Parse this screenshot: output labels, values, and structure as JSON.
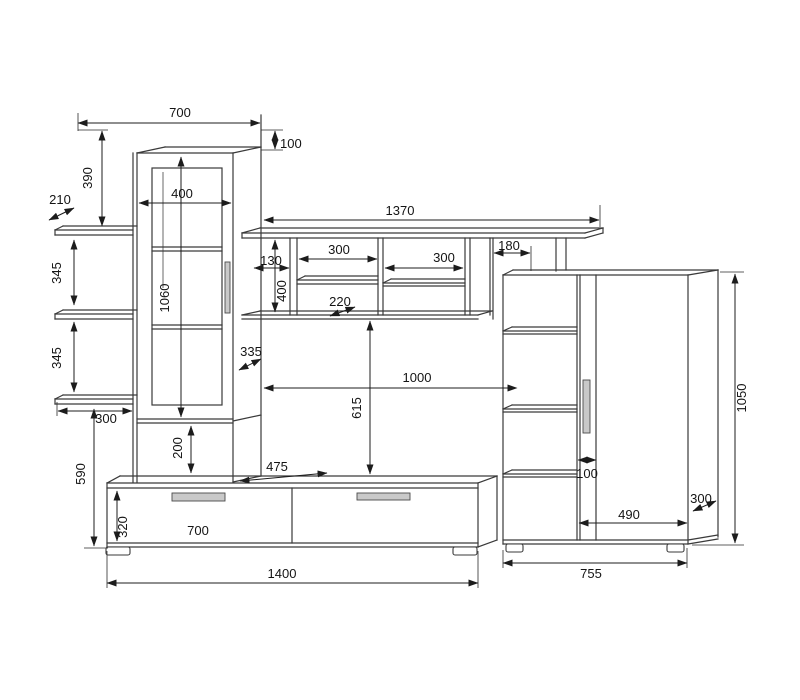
{
  "drawing_type": "furniture-wall-unit-dimension-diagram",
  "colors": {
    "background": "#ffffff",
    "line": "#3a3a3a",
    "dimension": "#1c1c1c",
    "handle_fill": "#c9c9c9"
  },
  "dimensions": {
    "top_cabinet": {
      "width": "700",
      "top_offset": "100",
      "drop": "390",
      "glass_width": "400",
      "glass_height": "1060",
      "depth": "335",
      "base_niche": "200"
    },
    "left_shelves": {
      "depth": "210",
      "gap_upper": "345",
      "gap_lower": "345",
      "width": "300",
      "height": "590"
    },
    "bridge_shelf": {
      "width": "1370",
      "slot": "130",
      "niche_left": "300",
      "niche_right": "300",
      "right_offset": "180",
      "height": "400",
      "shelf_depth": "220"
    },
    "tv_area": {
      "width": "1000",
      "height": "615"
    },
    "stand": {
      "depth": "475",
      "front_height": "320",
      "drawer_width": "700",
      "total_width": "1400"
    },
    "right_cabinet": {
      "door_gap": "100",
      "door_width": "490",
      "depth": "300",
      "height": "1050",
      "width": "755"
    }
  }
}
